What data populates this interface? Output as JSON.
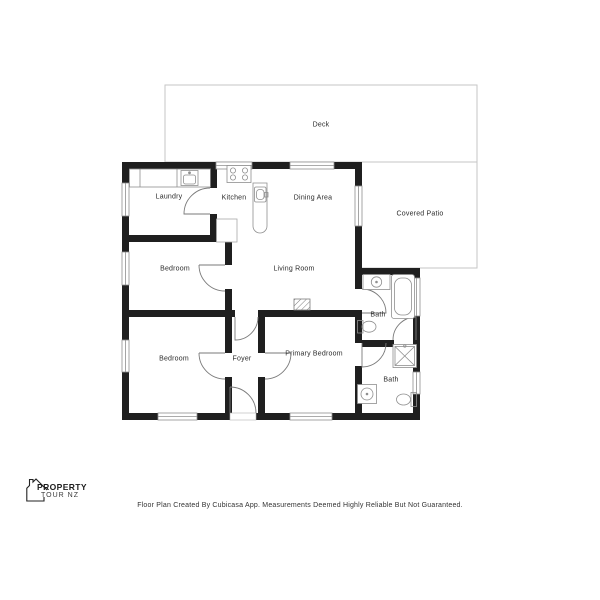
{
  "branding": {
    "logo_line1": "PROPERTY",
    "logo_line2": "TOUR NZ",
    "logo_icon": "house-outline-icon"
  },
  "rooms": {
    "deck": "Deck",
    "laundry": "Laundry",
    "kitchen": "Kitchen",
    "dining_area": "Dining Area",
    "covered_patio": "Covered Patio",
    "bedroom_left": "Bedroom",
    "living_room": "Living Room",
    "bath_main": "Bath",
    "bedroom_lower": "Bedroom",
    "foyer": "Foyer",
    "primary_bedroom": "Primary Bedroom",
    "bath_ensuite": "Bath"
  },
  "fixtures": [
    "stove-icon",
    "kitchen-island-sink-icon",
    "laundry-sink-icon",
    "vanity-sink-icon",
    "bathtub-icon",
    "toilet-icon",
    "shower-icon",
    "fireplace-icon"
  ],
  "footer": {
    "disclaimer": "Floor Plan Created By Cubicasa App. Measurements Deemed Highly Reliable But Not Guaranteed."
  },
  "colors": {
    "wall": "#1f1f1f",
    "fixture_line": "#8f8f8f",
    "outdoor_line": "#c6c6c6",
    "text": "#333333"
  }
}
